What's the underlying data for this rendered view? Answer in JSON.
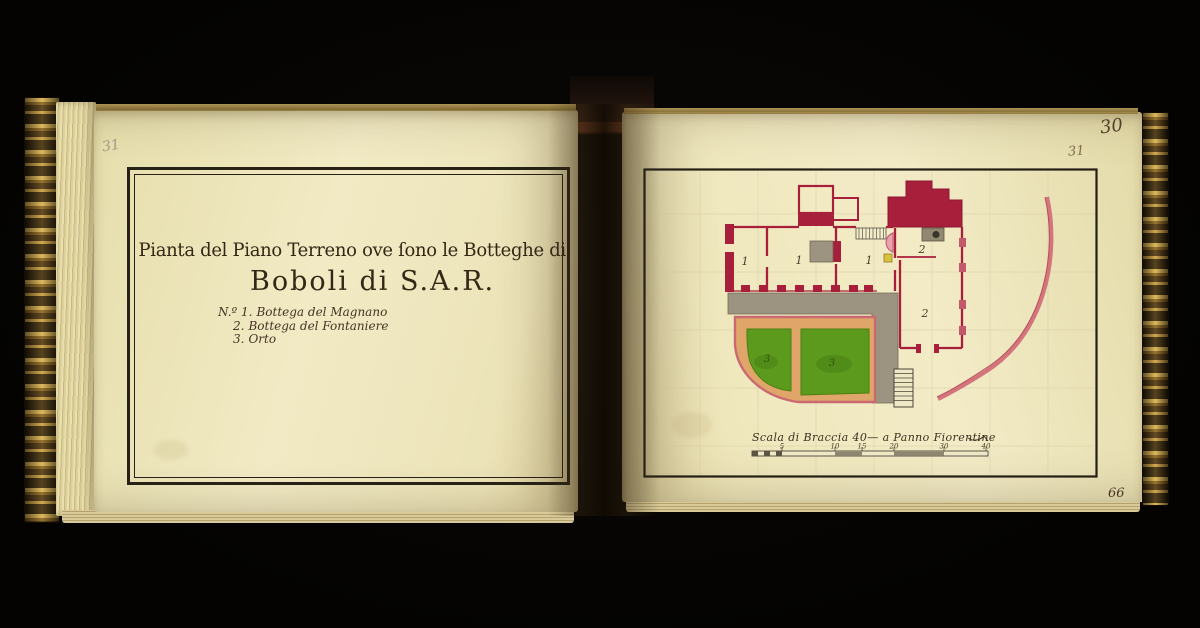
{
  "book": {
    "left_page": {
      "pencil_folio": "31",
      "title_line1": "Pianta del Piano Terreno ove ſono le Botteghe di",
      "title_line2": "Boboli di S.A.R.",
      "legend_items": [
        {
          "num": "N.º 1.",
          "label": "Bottega del Magnano"
        },
        {
          "num": "2.",
          "label": "Bottega del Fontaniere"
        },
        {
          "num": "3.",
          "label": "Orto"
        }
      ]
    },
    "right_page": {
      "pencil_folio": "31",
      "corner_folio": "30",
      "bottom_folio": "66",
      "plan": {
        "room_labels": [
          {
            "id": "bottega-magnano-left",
            "text": "1"
          },
          {
            "id": "bottega-magnano-middle",
            "text": "1"
          },
          {
            "id": "bottega-magnano-right",
            "text": "1"
          },
          {
            "id": "bottega-fontaniere-upper",
            "text": "2"
          },
          {
            "id": "bottega-fontaniere-lower",
            "text": "2"
          },
          {
            "id": "orto-left-bed",
            "text": "3"
          },
          {
            "id": "orto-right-bed",
            "text": "3"
          }
        ],
        "scale_caption": "Scala di Braccia 40— a Panno Fiorentine",
        "scale_ticks": [
          "5",
          "10",
          "15",
          "20",
          "30",
          "40"
        ]
      },
      "colors": {
        "wall_crimson": "#a81f3c",
        "boundary_arc_pink": "#d4757d",
        "terrace_gray": "#9c9480",
        "garden_green": "#5c9a1c",
        "path_tan": "#e0a669",
        "paper_cream": "#efe7bf"
      }
    }
  }
}
